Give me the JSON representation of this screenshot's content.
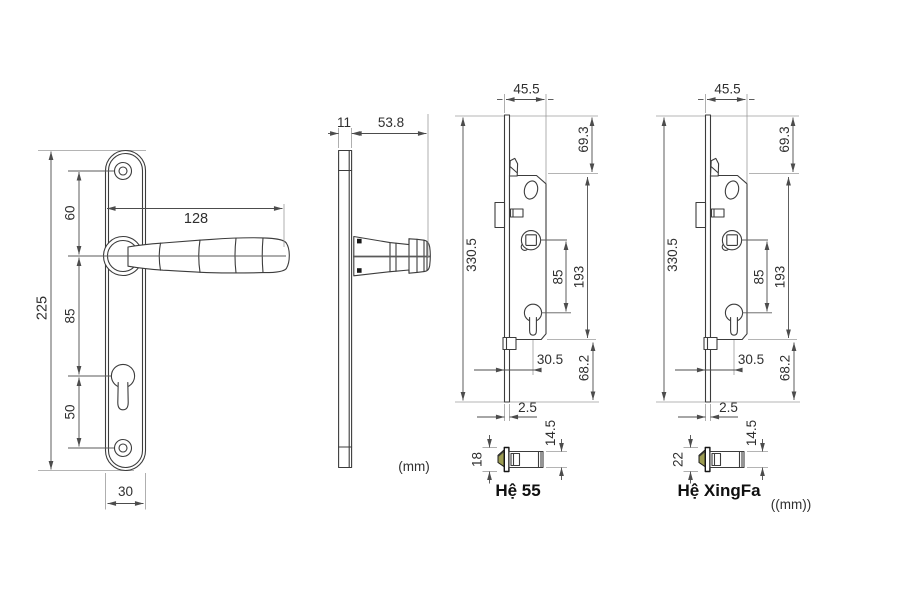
{
  "drawing": {
    "title_semantic": "door-handle-and-mortise-lock-dimension-drawing",
    "front_view": {
      "plate_height": "225",
      "top_screw_to_handle": "60",
      "handle_to_keyhole": "85",
      "keyhole_to_bottom_screw": "50",
      "plate_width": "30",
      "handle_length": "128"
    },
    "side_view": {
      "plate_thickness": "11",
      "handle_projection": "53.8",
      "unit_note": "(mm)"
    },
    "locks": [
      {
        "label": "Hệ 55",
        "case_width": "45.5",
        "top_to_case": "69.3",
        "faceplate_height": "330.5",
        "spindle_to_cylinder": "85",
        "case_height": "193",
        "backset": "30.5",
        "case_to_bottom": "68.2",
        "faceplate_thickness": "2.5",
        "latch_plate_height": "18",
        "latch_body_height": "14.5"
      },
      {
        "label": "Hệ XingFa",
        "case_width": "45.5",
        "top_to_case": "69.3",
        "faceplate_height": "330.5",
        "spindle_to_cylinder": "85",
        "case_height": "193",
        "backset": "30.5",
        "case_to_bottom": "68.2",
        "faceplate_thickness": "2.5",
        "latch_plate_height": "22",
        "latch_body_height": "14.5"
      }
    ],
    "unit_note_right": "((mm))"
  },
  "colors": {
    "outline": "#3c3c3c",
    "dimension": "#4c4c4c",
    "extension": "#9b9b9b",
    "text": "#2f2f2f",
    "latch_bevel": "#9c9c52",
    "background": "#ffffff"
  }
}
